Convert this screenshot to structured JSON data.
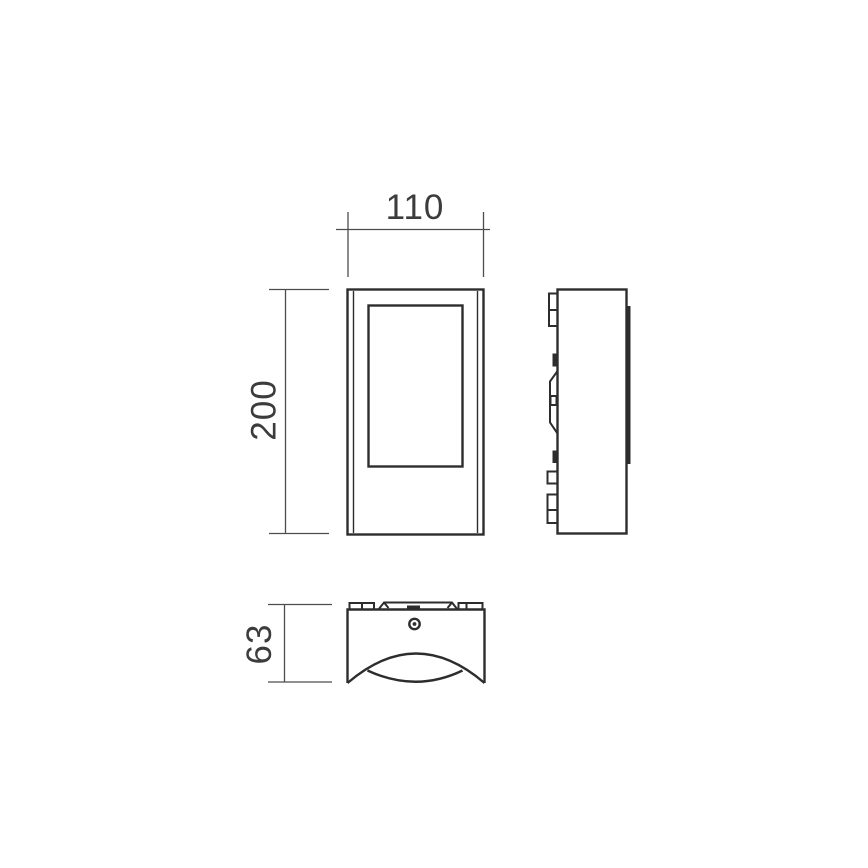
{
  "drawing": {
    "kind": "technical-dimension-drawing",
    "subject": "wall-light-fixture",
    "colors": {
      "background": "#ffffff",
      "line": "#2d2d2d",
      "dimension_line": "#4d4d4d",
      "text": "#3c3c3c"
    },
    "dimensions": {
      "width": {
        "value": "110",
        "orientation": "horizontal"
      },
      "height": {
        "value": "200",
        "orientation": "vertical"
      },
      "depth": {
        "value": "63",
        "orientation": "vertical"
      }
    }
  }
}
